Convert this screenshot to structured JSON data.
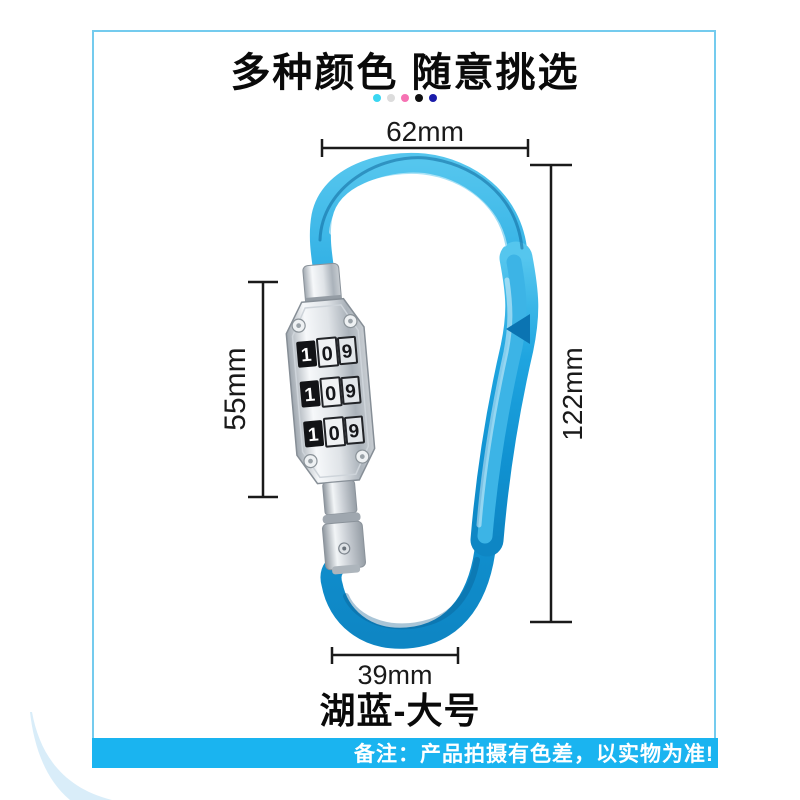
{
  "title": "多种颜色 随意挑选",
  "color_dots": [
    "#3ad6f1",
    "#dcdcdc",
    "#f672b3",
    "#0f0f0f",
    "#1b1caa"
  ],
  "dimensions": {
    "top_width": "62mm",
    "lock_height": "55mm",
    "total_height": "122mm",
    "bottom_width": "39mm"
  },
  "lock": {
    "dials": [
      [
        "1",
        "0",
        "9"
      ],
      [
        "1",
        "0",
        "9"
      ],
      [
        "1",
        "0",
        "9"
      ]
    ]
  },
  "product_name": "湖蓝-大号",
  "footer_note": "备注：产品拍摄有色差，以实物为准!",
  "colors": {
    "carabiner_blue": "#1aa3de",
    "carabiner_highlight": "#55c6ee",
    "carabiner_dark": "#0d7fc0",
    "footer_bar": "#1ab4f0",
    "frame_line": "#74cbee",
    "swoosh": "#d9edf9"
  }
}
